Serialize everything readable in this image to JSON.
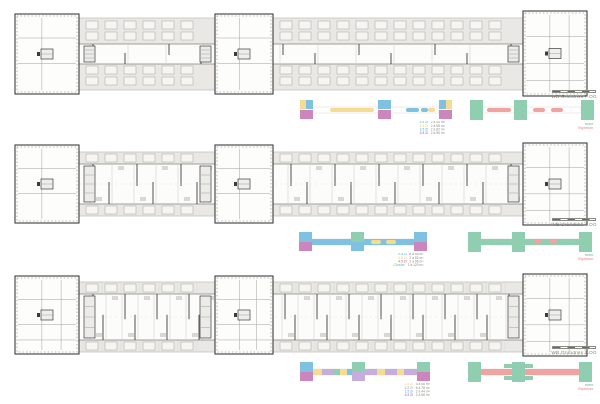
{
  "sheet": {
    "background": "#ffffff"
  },
  "palette": {
    "band": "#e9e8e4",
    "band_stroke": "#bcbbb6",
    "wall": "#3c3c3c",
    "light_line": "#c4c3be",
    "blue": "#7fc1e0",
    "magenta": "#cb86bd",
    "yellow": "#f4dd92",
    "green": "#8fceb0",
    "pink": "#f0a3a1",
    "lavender": "#c5aede",
    "label_text": "#85857f"
  },
  "plans": [
    {
      "label": "WB Grundriss 7.OG"
    },
    {
      "label": "WB Grundriss 4.OG"
    },
    {
      "label": "WB Grundriss 1.OG"
    }
  ],
  "diagrams": [
    {
      "left": {
        "width": 152,
        "shapes": [
          [
            0,
            1,
            6,
            9,
            "yellow"
          ],
          [
            6,
            1,
            7,
            9,
            "blue"
          ],
          [
            0,
            11,
            13,
            9,
            "magenta"
          ],
          [
            30,
            9,
            44,
            4,
            "yellow",
            2
          ],
          [
            78,
            1,
            13,
            9,
            "blue"
          ],
          [
            78,
            11,
            13,
            9,
            "magenta"
          ],
          [
            106,
            9,
            13,
            4,
            "blue",
            2
          ],
          [
            121,
            9,
            7,
            4,
            "blue",
            2
          ],
          [
            128,
            9,
            7,
            4,
            "yellow",
            2
          ],
          [
            139,
            1,
            7,
            9,
            "blue"
          ],
          [
            146,
            1,
            6,
            9,
            "yellow"
          ],
          [
            139,
            11,
            13,
            9,
            "magenta"
          ]
        ],
        "legend": [
          {
            "color": "blue",
            "label": "1.5 Zi",
            "value": "2 à 44 m²"
          },
          {
            "color": "yellow",
            "label": "2.5 Zi",
            "value": "2 à 58 m²"
          },
          {
            "color": "blue",
            "label": "3.5 Zi",
            "value": "2 à 82 m²"
          },
          {
            "color": "magenta",
            "label": "4.5 Zi",
            "value": "2 à 96 m²"
          }
        ]
      },
      "right": {
        "width": 124,
        "shapes": [
          [
            0,
            1,
            13,
            20,
            "green"
          ],
          [
            44,
            1,
            13,
            20,
            "green"
          ],
          [
            111,
            1,
            13,
            20,
            "green"
          ],
          [
            17,
            9,
            24,
            4,
            "pink",
            2
          ],
          [
            63,
            9,
            12,
            4,
            "pink",
            2
          ],
          [
            81,
            9,
            12,
            4,
            "pink",
            2
          ]
        ],
        "legend": [
          {
            "color": "green",
            "label": "Miete",
            "value": ""
          },
          {
            "color": "pink",
            "label": "Eigentum",
            "value": ""
          }
        ]
      }
    },
    {
      "left": {
        "width": 128,
        "shapes": [
          [
            11,
            8,
            106,
            6,
            "blue"
          ],
          [
            0,
            1,
            13,
            10,
            "blue"
          ],
          [
            0,
            11,
            13,
            9,
            "magenta"
          ],
          [
            52,
            1,
            13,
            10,
            "green"
          ],
          [
            52,
            11,
            13,
            9,
            "blue"
          ],
          [
            115,
            1,
            13,
            10,
            "blue"
          ],
          [
            115,
            11,
            13,
            9,
            "magenta"
          ],
          [
            72,
            9,
            10,
            4,
            "yellow",
            2
          ],
          [
            87,
            9,
            10,
            4,
            "yellow",
            2
          ]
        ],
        "legend": [
          {
            "color": "blue",
            "label": "2.5 Zi",
            "value": "8 à 58 m²"
          },
          {
            "color": "yellow",
            "label": "3.5 Zi",
            "value": "2 à 82 m²"
          },
          {
            "color": "magenta",
            "label": "4.5 Zi",
            "value": "2 à 96 m²"
          },
          {
            "color": "green",
            "label": "Cluster",
            "value": "1 à 120 m²"
          }
        ]
      },
      "right": {
        "width": 124,
        "shapes": [
          [
            11,
            8,
            102,
            6,
            "green"
          ],
          [
            0,
            1,
            13,
            20,
            "green"
          ],
          [
            44,
            1,
            13,
            20,
            "green"
          ],
          [
            111,
            1,
            13,
            20,
            "green"
          ],
          [
            66,
            9,
            8,
            4,
            "pink",
            2
          ],
          [
            81,
            9,
            8,
            4,
            "pink",
            2
          ]
        ],
        "legend": [
          {
            "color": "green",
            "label": "Miete",
            "value": ""
          },
          {
            "color": "pink",
            "label": "Eigentum",
            "value": ""
          }
        ]
      }
    },
    {
      "left": {
        "width": 130,
        "shapes": [
          [
            0,
            1,
            13,
            10,
            "blue"
          ],
          [
            0,
            11,
            13,
            9,
            "magenta"
          ],
          [
            52,
            1,
            13,
            10,
            "green"
          ],
          [
            52,
            11,
            13,
            9,
            "lavender"
          ],
          [
            117,
            1,
            13,
            10,
            "green"
          ],
          [
            117,
            11,
            13,
            9,
            "magenta"
          ],
          [
            13,
            8,
            9,
            6,
            "yellow"
          ],
          [
            22,
            8,
            11,
            6,
            "lavender"
          ],
          [
            33,
            8,
            7,
            6,
            "green"
          ],
          [
            40,
            8,
            7,
            6,
            "yellow"
          ],
          [
            47,
            8,
            5,
            6,
            "blue"
          ],
          [
            65,
            8,
            12,
            6,
            "lavender"
          ],
          [
            77,
            8,
            8,
            6,
            "yellow"
          ],
          [
            85,
            8,
            12,
            6,
            "lavender"
          ],
          [
            97,
            8,
            7,
            6,
            "yellow"
          ],
          [
            104,
            8,
            13,
            6,
            "lavender"
          ]
        ],
        "legend": [
          {
            "color": "yellow",
            "label": "2.5 Zi",
            "value": "4 à 58 m²"
          },
          {
            "color": "lavender",
            "label": "3.5 Zi",
            "value": "6 à 78 m²"
          },
          {
            "color": "blue",
            "label": "1.5 Zi",
            "value": "2 à 44 m²"
          },
          {
            "color": "magenta",
            "label": "4.5 Zi",
            "value": "2 à 96 m²"
          }
        ]
      },
      "right": {
        "width": 124,
        "shapes": [
          [
            11,
            8,
            102,
            6,
            "pink"
          ],
          [
            0,
            1,
            13,
            20,
            "green"
          ],
          [
            44,
            1,
            13,
            20,
            "green"
          ],
          [
            111,
            1,
            13,
            20,
            "green"
          ],
          [
            36,
            3,
            8,
            4,
            "green"
          ],
          [
            57,
            3,
            8,
            4,
            "green"
          ],
          [
            36,
            15,
            8,
            4,
            "green"
          ],
          [
            57,
            15,
            8,
            4,
            "green"
          ]
        ],
        "legend": [
          {
            "color": "green",
            "label": "Miete",
            "value": ""
          },
          {
            "color": "pink",
            "label": "Eigentum",
            "value": ""
          }
        ]
      }
    }
  ]
}
